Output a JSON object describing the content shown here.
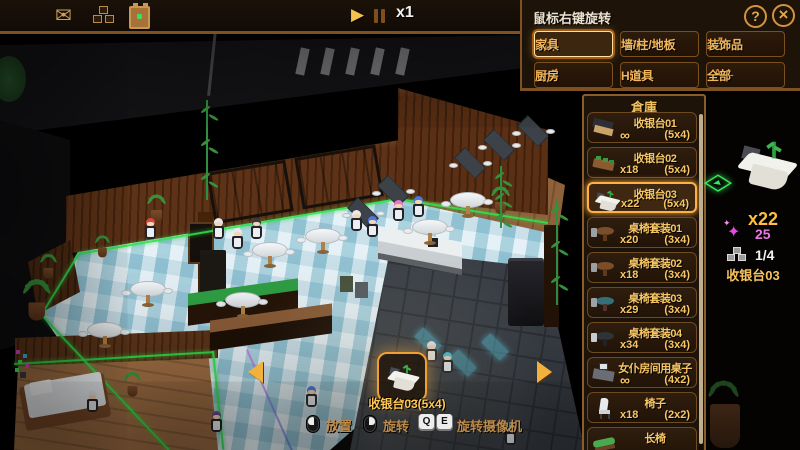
{
  "top_bar": {
    "icons": [
      "mail-icon",
      "storage-boxes-icon",
      "delivery-box-icon"
    ],
    "play_label": "▶",
    "speed": "x1"
  },
  "build_menu": {
    "hint": "鼠标右键旋转",
    "help_label": "?",
    "close_label": "×",
    "categories": [
      {
        "label": "家具",
        "icon": "chair",
        "selected": true
      },
      {
        "label": "墙/柱/地板",
        "icon": "floor",
        "selected": false
      },
      {
        "label": "装饰品",
        "icon": "vase",
        "selected": false
      },
      {
        "label": "厨房",
        "icon": "pan",
        "selected": false
      },
      {
        "label": "H道具",
        "icon": "glasses",
        "selected": false
      },
      {
        "label": "全部",
        "icon": "all",
        "icon_text": "ALL",
        "selected": false
      }
    ]
  },
  "warehouse": {
    "title": "倉庫",
    "items": [
      {
        "name": "收银台01",
        "count": "∞",
        "size": "(5x4)",
        "icon": "register-01",
        "selected": false
      },
      {
        "name": "收银台02",
        "count": "x18",
        "size": "(5x4)",
        "icon": "register-02",
        "selected": false
      },
      {
        "name": "收银台03",
        "count": "x22",
        "size": "(5x4)",
        "icon": "register-03",
        "selected": true
      },
      {
        "name": "桌椅套装01",
        "count": "x20",
        "size": "(3x4)",
        "icon": "table-set-1",
        "selected": false
      },
      {
        "name": "桌椅套装02",
        "count": "x18",
        "size": "(3x4)",
        "icon": "table-set-1",
        "selected": false
      },
      {
        "name": "桌椅套装03",
        "count": "x29",
        "size": "(3x4)",
        "icon": "table-set-2",
        "selected": false
      },
      {
        "name": "桌椅套装04",
        "count": "x34",
        "size": "(3x4)",
        "icon": "table-set-3",
        "selected": false
      },
      {
        "name": "女仆房间用桌子",
        "count": "∞",
        "size": "(4x2)",
        "icon": "maid-desk",
        "selected": false
      },
      {
        "name": "椅子",
        "count": "x18",
        "size": "(2x2)",
        "icon": "chair",
        "selected": false
      },
      {
        "name": "长椅",
        "count": "",
        "size": "",
        "icon": "bench",
        "selected": false
      }
    ]
  },
  "selected_item": {
    "quantity": "x22",
    "gem_icon": "gem-sparkle-icon",
    "gem_cost": "25",
    "stock_icon": "stock-boxes-icon",
    "stock": "1/4",
    "name": "收银台03",
    "rotate_marker_icon": "rotate-marker-icon"
  },
  "placement": {
    "label": "收银台03(5x4)"
  },
  "hints": {
    "place": "放置",
    "rotate": "旋转",
    "key_q": "Q",
    "key_e": "E",
    "camera": "旋转摄像机"
  },
  "colors": {
    "accent_gold": "#f2b75c",
    "selected_border": "#ffb143",
    "panel_bg": "#1d1309",
    "gem_pink": "#e87ae0",
    "grid_green": "#2ee44e",
    "floor_blue": "#bfdde8"
  }
}
